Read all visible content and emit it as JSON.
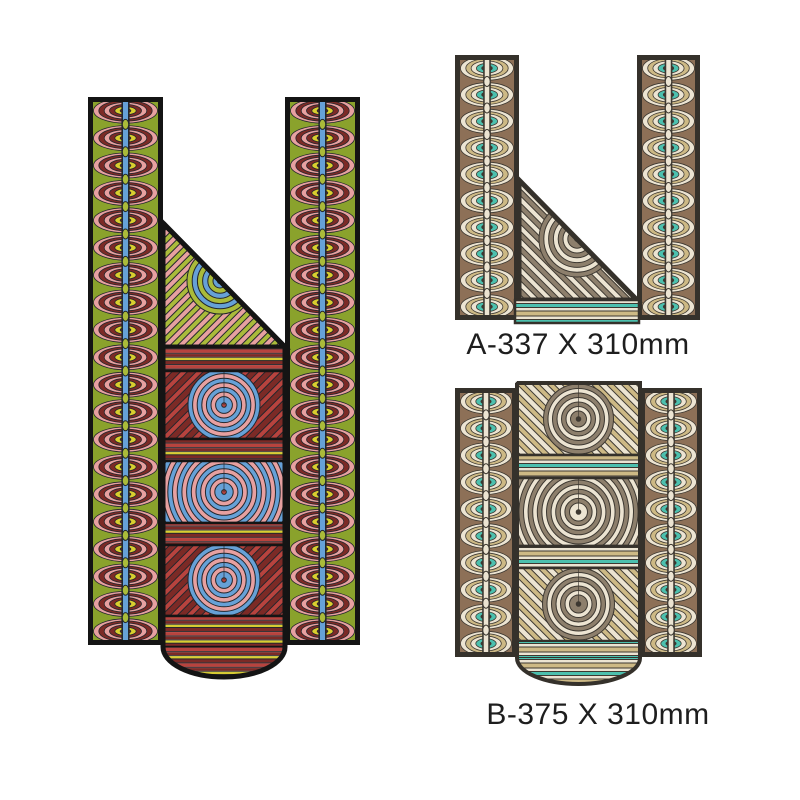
{
  "page": {
    "background": "#ffffff"
  },
  "labels": {
    "design_a": "A-337 X 310mm",
    "design_b": "B-375 X 310mm"
  },
  "palette": {
    "label_text": "#1e1e1e",
    "colorful": {
      "bg": "#8aa22c",
      "lime": "#aabb3a",
      "maroon": "#7c2a26",
      "red": "#b8433e",
      "pink": "#e7a0a0",
      "yellow": "#d9ce2f",
      "blue": "#66a1d7",
      "dark": "#23262c",
      "outline": "#141414"
    },
    "earthy": {
      "bg": "#8d7057",
      "cream": "#ece4d2",
      "tan": "#cdb985",
      "teal": "#4cc0ae",
      "gray": "#8d7f6c",
      "dark": "#3d3831",
      "outline": "#35312b"
    }
  }
}
